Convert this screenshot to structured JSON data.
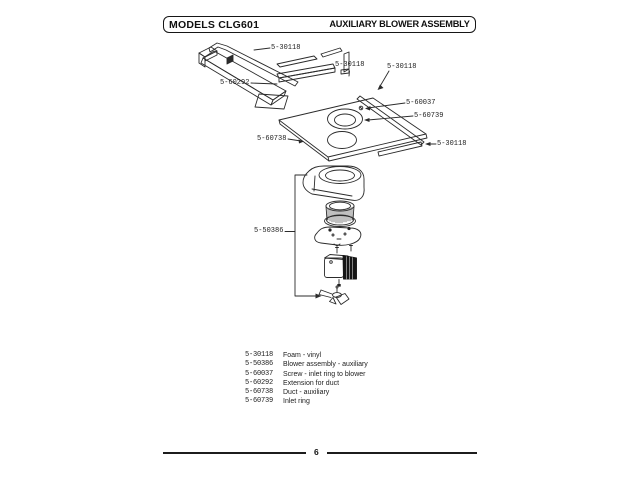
{
  "header": {
    "models": "MODELS CLG601",
    "title": "AUXILIARY BLOWER ASSEMBLY"
  },
  "diagram": {
    "callouts": [
      {
        "part": "foam-strip-top",
        "label": "5-30118"
      },
      {
        "part": "extension-for-duct",
        "label": "5-60292"
      },
      {
        "part": "foam-strip-center",
        "label": "5-30118"
      },
      {
        "part": "foam-strip-right",
        "label": "5-30118"
      },
      {
        "part": "screw-inlet-ring",
        "label": "5-60037"
      },
      {
        "part": "inlet-ring",
        "label": "5-60739"
      },
      {
        "part": "duct-auxiliary",
        "label": "5-60738"
      },
      {
        "part": "foam-strip-bottom",
        "label": "5-30118"
      },
      {
        "part": "blower-assembly",
        "label": "5-50386"
      }
    ]
  },
  "parts_list": {
    "rows": [
      {
        "number": "5-30118",
        "description": "Foam - vinyl"
      },
      {
        "number": "5-50386",
        "description": "Blower assembly - auxiliary"
      },
      {
        "number": "5-60037",
        "description": "Screw - inlet ring to blower"
      },
      {
        "number": "5-60292",
        "description": "Extension for duct"
      },
      {
        "number": "5-60738",
        "description": "Duct - auxiliary"
      },
      {
        "number": "5-60739",
        "description": "Inlet ring"
      }
    ]
  },
  "footer": {
    "page_number": "6"
  },
  "colors": {
    "ink": "#2b2b2b",
    "paper": "#ffffff"
  }
}
